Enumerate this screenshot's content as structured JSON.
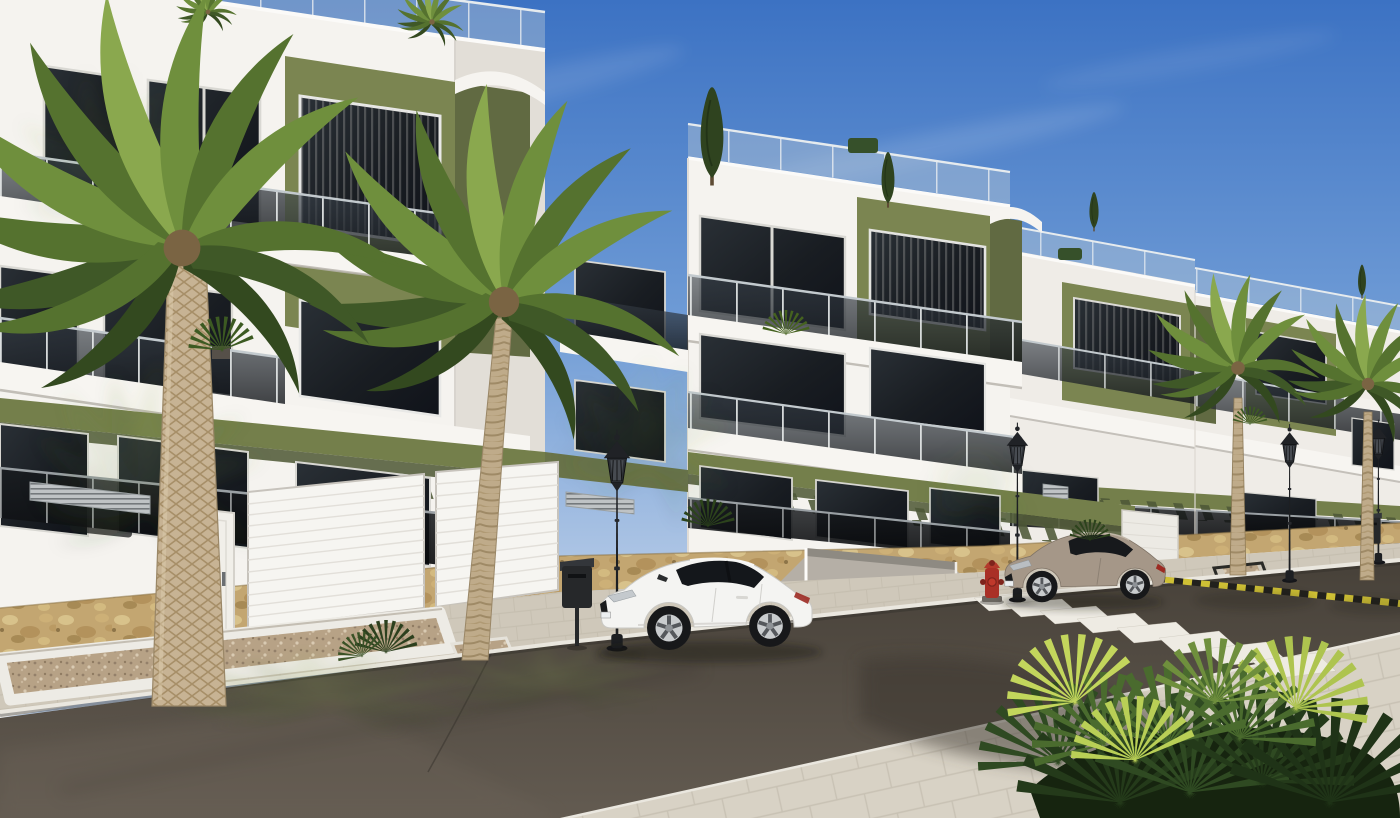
{
  "meta": {
    "type": "3d-architectural-render",
    "description": "Sunny exterior render of a new-build modern apartment complex: white facades with olive-green accent volumes, tinted glass balconies, street wall with natural stone base and garage doors, palm trees, classic black street lamps, a white coupe and a grey coupe parked along a dark asphalt road with a zebra crossing and a yellow-black raised platform edge, pale paver sidewalk and a spiky fan-palm shrub in the foreground corner."
  },
  "colors": {
    "sky_top": "#3c72c3",
    "sky_mid": "#6d9ad5",
    "sky_horizon": "#bccfe8",
    "facade_white": "#f5f3ef",
    "facade_shade": "#e2ded7",
    "facade_far": "#efece7",
    "accent_olive": "#7b8551",
    "accent_olive_shade": "#616a42",
    "pergola_olive": "#747f4b",
    "glass_frame": "#d9d8d3",
    "slab_white": "#f7f5f1",
    "stone_tan": "#c3a671",
    "pavement": "#cfc8ba",
    "pavement_sun": "#d8d2c5",
    "curb_white": "#eae7df",
    "asphalt_dark": "#474139",
    "asphalt_light": "#635b51",
    "crosswalk_white": "#eeebe3",
    "hazard_yellow": "#cfc035",
    "hazard_black": "#22211d",
    "palm_dark": "#3f5827",
    "palm_mid": "#55722f",
    "palm_light": "#6f8f3d",
    "palm_highlight": "#8aa84e",
    "trunk_tan": "#c7b394",
    "gravel": "#b7a286",
    "car_white": "#f4f4f2",
    "car_gray": "#a59788",
    "tire_black": "#17181a",
    "rim_silver": "#c9ccce",
    "lamp_black": "#1d1f22",
    "bin_black": "#26282a",
    "hydrant_red": "#a93026",
    "taillight_red": "#9c2a22",
    "cypress_green": "#2f431f"
  },
  "scene": {
    "buildings": [
      {
        "name": "left-block",
        "storeys": 3,
        "style": "white facade, olive accent volume, tinted glass balconies, rooftop glass railing"
      },
      {
        "name": "center-block",
        "storeys": 3,
        "style": "white facade, olive accent volume, green pergola slats, rooftop trees"
      },
      {
        "name": "right-blocks",
        "storeys": 3,
        "style": "two receding stepped blocks with olive accents"
      }
    ],
    "street_level": {
      "garage_doors": 2,
      "pedestrian_door": 1,
      "driveway_ramp": 1,
      "stone_base": true,
      "vent_grilles": 3
    },
    "vehicles": [
      {
        "name": "white-coupe",
        "color_key": "car_white",
        "position": "parked along left curb"
      },
      {
        "name": "gray-coupe",
        "color_key": "car_gray",
        "position": "parked right of driveway"
      }
    ],
    "road": {
      "crosswalk_stripes": 8,
      "hazard_platform_edge": true,
      "surface": "dark asphalt"
    },
    "vegetation": {
      "large_palms": 2,
      "medium_palms": 2,
      "rooftop_trees": 4,
      "fan_palm_shrub": 1,
      "balcony_plants": 5
    },
    "props": {
      "street_lamps": 4,
      "trash_bins": 2,
      "fire_hydrants": 1
    }
  }
}
